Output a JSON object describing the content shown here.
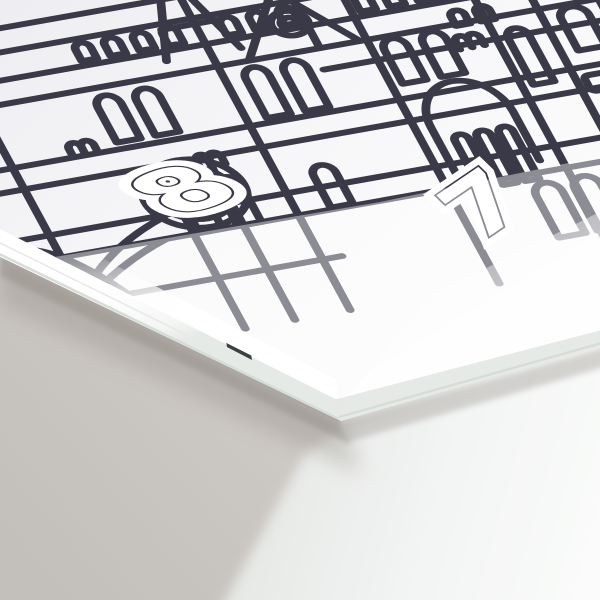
{
  "artwork": {
    "subject": "gothic-cathedral-line-illustration",
    "numbers": {
      "left": "8",
      "right": "7"
    }
  },
  "colors": {
    "ink": "#3a3947",
    "ink_washed": "#8f8e9a",
    "card_face": "#f6f6f8",
    "card_edge_white": "#fdfefd",
    "board_side": "#e9ede9",
    "under_sheet": "#f3f5f4",
    "background_dark": "#c5c1bd",
    "background_light": "#dedad7",
    "edge_mark": "#2b3233",
    "glare": "#ffffff"
  }
}
